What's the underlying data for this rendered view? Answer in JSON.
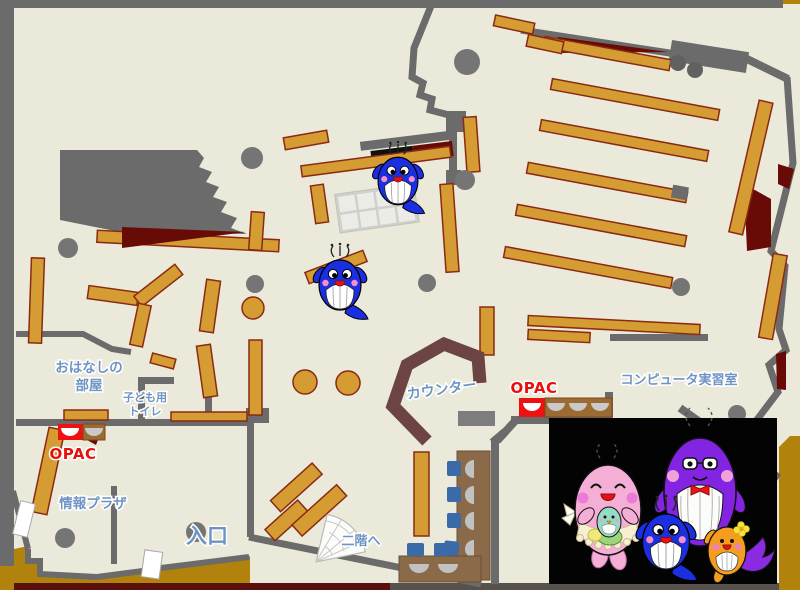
{
  "map": {
    "rooms": {
      "storytelling_room": {
        "label_line1": "おはなしの",
        "label_line2": "部屋"
      },
      "kids_toilet": {
        "label_line1": "子ども用",
        "label_line2": "トイレ"
      },
      "info_plaza": {
        "label": "情報プラザ"
      },
      "computer_room": {
        "label": "コンピュータ実習室"
      }
    },
    "points": {
      "entrance": {
        "label": "入口"
      },
      "counter": {
        "label": "カウンター"
      },
      "opac_left": {
        "label": "OPAC"
      },
      "opac_right": {
        "label": "OPAC"
      },
      "stairs_to_second_floor": {
        "label": "二階へ"
      }
    },
    "colors": {
      "background_gold": "#b2830c",
      "floor_cream": "#ebeada",
      "wall_gray": "#6b6b6b",
      "shelf_fill": "#d59c33",
      "shelf_border": "#8a2a12",
      "accent_dark_red": "#680b06",
      "counter_brown": "#6d4444",
      "label_blue": "#6e93c5",
      "opac_red": "#e8100c",
      "chair_blue": "#3a6ba8",
      "desk_brown": "#8a6a49",
      "photo_background": "#000000",
      "whale_blue": "#1b2fe0",
      "whale_pink": "#f5aed6",
      "whale_purple": "#8224e2",
      "whale_orange": "#f59d1e"
    },
    "mascots": {
      "on_map": [
        "blue-whale-upper",
        "blue-whale-lower"
      ],
      "family_photo": [
        "pink-whale-with-baby",
        "blue-whale-child",
        "purple-whale-with-glasses",
        "orange-whale-child"
      ]
    }
  }
}
